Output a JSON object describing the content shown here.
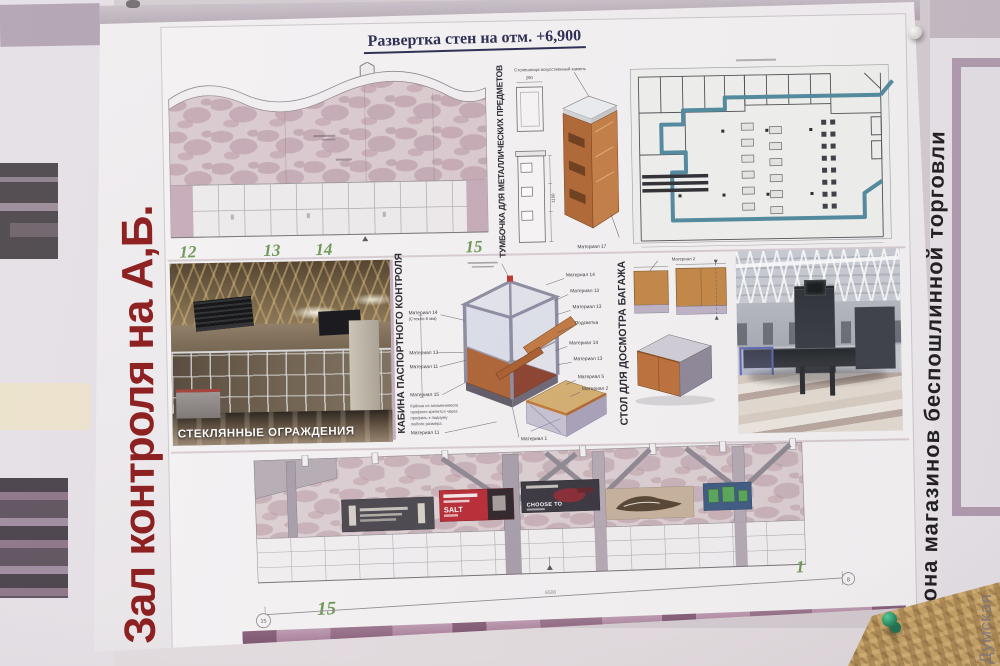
{
  "colors": {
    "side_title_red": "#8e1414",
    "plan_teal": "#4d8ba0",
    "axis_green": "#69984f",
    "banner_red": "#bf2630",
    "wood_orange": "#c8873f"
  },
  "watermark": "Думская",
  "left_poster": {
    "title_vertical": "Зал контроля на А,Б."
  },
  "sheet": {
    "title": "Развертка стен на отм. +6,900",
    "wall_elevation_top": {
      "axis_labels": [
        "12",
        "13",
        "14",
        "15"
      ]
    },
    "metal_cabinet": {
      "label": "ТУМБОЧКА ДЛЯ МЕТАЛЛИЧЕСКИХ ПРЕДМЕТОВ",
      "note": "Столешница искусственный камень",
      "material_label": "Материал 17",
      "dims": [
        "290",
        "1190"
      ]
    },
    "glass_photo_caption": "СТЕКЛЯННЫЕ ОГРАЖДЕНИЯ",
    "passport_cabin": {
      "label": "КАБИНА ПАСПОРТНОГО КОНТРОЛЯ",
      "callouts_left": [
        "Материал 14",
        "(Стекло 6 мм)",
        "Материал 13",
        "Материал 11",
        "Материал 15",
        "Материал 11"
      ],
      "callouts_right": [
        "Материал 14",
        "Материал 13",
        "Материал 13",
        "Подсветка",
        "Материал 14",
        "Материал 13",
        "Материал 5",
        "Материал 2",
        "Материал 1"
      ],
      "note_lines": [
        "Кабина из алюминиевого",
        "профиля крепится через",
        "профиль к подиуму",
        "любого размера"
      ]
    },
    "baggage_table": {
      "label": "СТОЛ ДЛЯ ДОСМОТРА БАГАЖА",
      "callout": "Материал 2"
    },
    "wall_elevation_bottom": {
      "axis_left": "15",
      "axis_right": "1",
      "dim": "6500",
      "marker_left": "15",
      "marker_right": "8",
      "banner_red_text": "SALT",
      "banner_dark_text": "CHOOSE TO"
    }
  },
  "right_poster": {
    "title_vertical": "Зона магазинов беспошлинной торговли"
  }
}
